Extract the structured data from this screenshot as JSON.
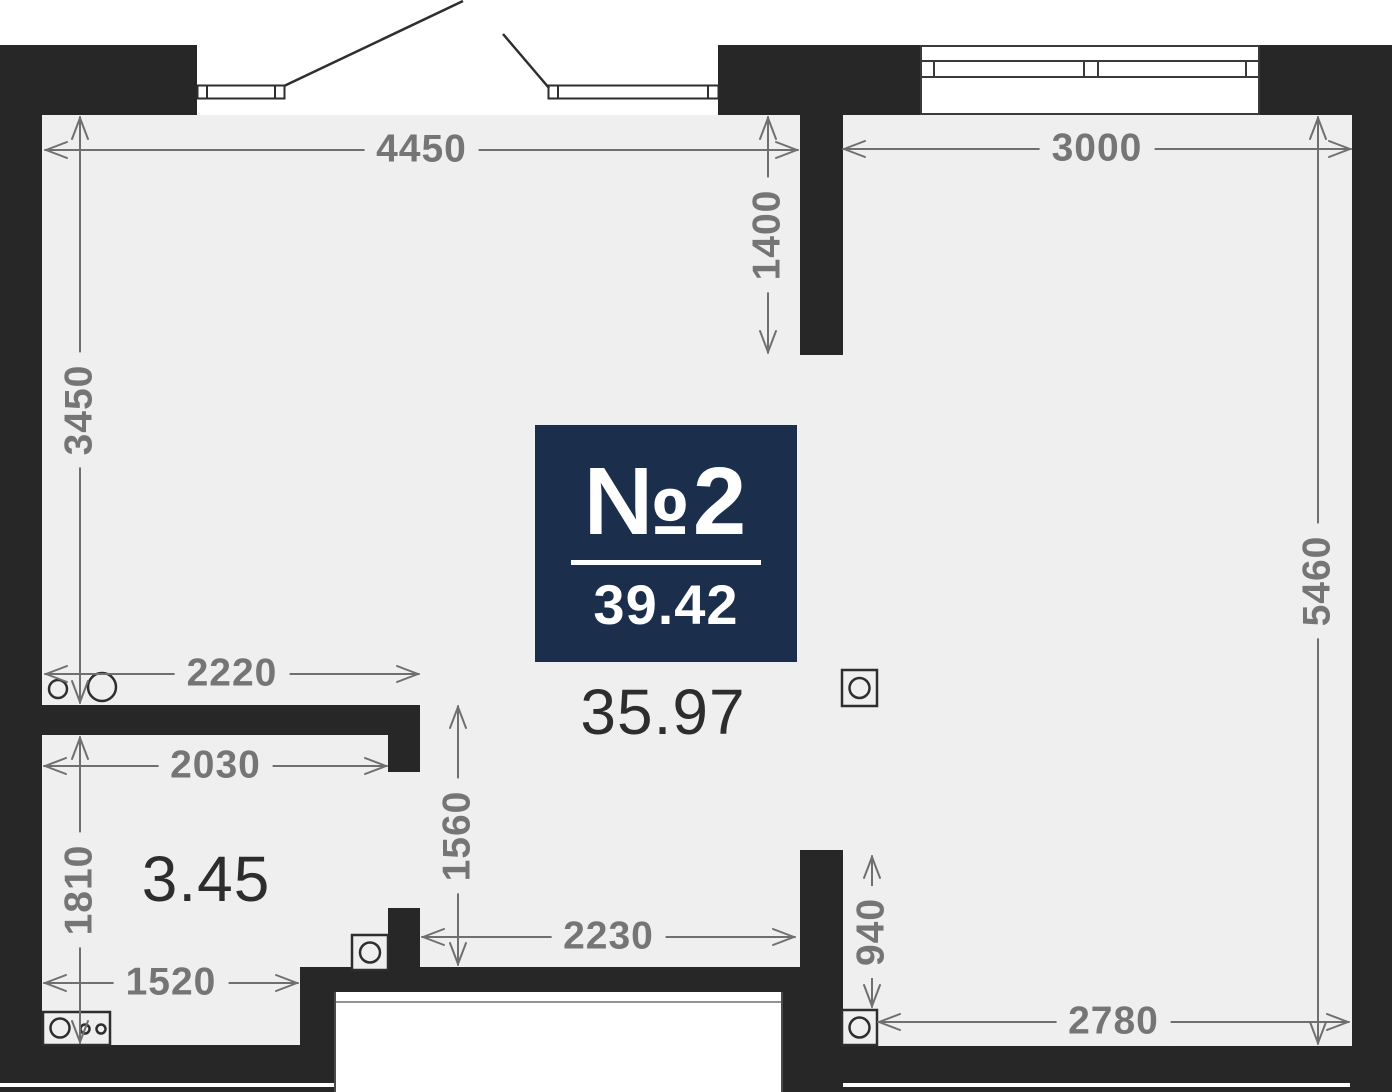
{
  "badge": {
    "number": "№2",
    "area": "39.42"
  },
  "room_areas": [
    {
      "id": "main-room",
      "label": "35.97",
      "x": 663,
      "y": 712
    },
    {
      "id": "kitchen",
      "label": "3.45",
      "x": 206,
      "y": 879
    }
  ],
  "dimensions": [
    {
      "label": "4450",
      "o": "h",
      "x1": 45,
      "x2": 798,
      "y": 150
    },
    {
      "label": "3000",
      "o": "h",
      "x1": 843,
      "x2": 1351,
      "y": 149
    },
    {
      "label": "2220",
      "o": "h",
      "x1": 45,
      "x2": 419,
      "y": 674
    },
    {
      "label": "2030",
      "o": "h",
      "x1": 44,
      "x2": 387,
      "y": 766
    },
    {
      "label": "2230",
      "o": "h",
      "x1": 422,
      "x2": 795,
      "y": 937
    },
    {
      "label": "1520",
      "o": "h",
      "x1": 44,
      "x2": 298,
      "y": 983
    },
    {
      "label": "2780",
      "o": "h",
      "x1": 878,
      "x2": 1349,
      "y": 1022
    },
    {
      "label": "3450",
      "o": "v",
      "y1": 117,
      "y2": 703,
      "x": 80
    },
    {
      "label": "1400",
      "o": "v",
      "y1": 117,
      "y2": 353,
      "x": 768
    },
    {
      "label": "5460",
      "o": "v",
      "y1": 117,
      "y2": 1044,
      "x": 1318
    },
    {
      "label": "1810",
      "o": "v",
      "y1": 737,
      "y2": 1043,
      "x": 80
    },
    {
      "label": "1560",
      "o": "v",
      "y1": 706,
      "y2": 965,
      "x": 458
    },
    {
      "label": "940",
      "o": "v",
      "y1": 856,
      "y2": 1007,
      "x": 872
    }
  ],
  "colors": {
    "wall": "#272727",
    "floor": "#efefef",
    "badge_bg": "#1b2f4d",
    "dim_line": "#6f6f6f",
    "dim_text": "#757575",
    "area_text": "#2d2d2d",
    "fixture_line": "#2e2e2e"
  },
  "geometry": {
    "floor": {
      "x": 42,
      "y": 115,
      "w": 1310,
      "h": 931
    },
    "walls": [
      {
        "x": 0,
        "y": 45,
        "w": 197,
        "h": 70
      },
      {
        "x": 0,
        "y": 45,
        "w": 42,
        "h": 1047
      },
      {
        "x": 718,
        "y": 45,
        "w": 202,
        "h": 70
      },
      {
        "x": 800,
        "y": 45,
        "w": 43,
        "h": 310
      },
      {
        "x": 1260,
        "y": 45,
        "w": 132,
        "h": 70
      },
      {
        "x": 1352,
        "y": 45,
        "w": 40,
        "h": 1047
      },
      {
        "x": 42,
        "y": 705,
        "w": 378,
        "h": 30
      },
      {
        "x": 388,
        "y": 735,
        "w": 32,
        "h": 37
      },
      {
        "x": 388,
        "y": 908,
        "w": 32,
        "h": 84
      },
      {
        "x": 300,
        "y": 967,
        "w": 500,
        "h": 25
      },
      {
        "x": 300,
        "y": 967,
        "w": 34,
        "h": 125
      },
      {
        "x": 0,
        "y": 1045,
        "w": 334,
        "h": 47
      },
      {
        "x": 800,
        "y": 850,
        "w": 43,
        "h": 242
      },
      {
        "x": 783,
        "y": 992,
        "w": 60,
        "h": 100
      },
      {
        "x": 797,
        "y": 1046,
        "w": 595,
        "h": 46
      }
    ],
    "inset_lines": [
      {
        "x": 0,
        "y": 1083,
        "w": 334,
        "h": 4
      },
      {
        "x": 843,
        "y": 1083,
        "w": 507,
        "h": 4
      }
    ],
    "niche": {
      "x": 334,
      "y": 992,
      "w": 449,
      "h": 100,
      "rail_offset": 9
    },
    "window": {
      "x": 920,
      "y": 45,
      "w": 340,
      "h": 70,
      "hline_offsets": [
        15,
        31
      ],
      "mullion_offsets": [
        13,
        163,
        177,
        325
      ]
    },
    "doors": [
      {
        "leaf": {
          "x": 197,
          "y": 85,
          "w": 87,
          "h": 13,
          "dividers": [
            207,
            275
          ]
        },
        "swing": [
          [
            284,
            86
          ],
          [
            463,
            1
          ]
        ]
      },
      {
        "leaf": {
          "x": 548,
          "y": 85,
          "w": 170,
          "h": 13,
          "dividers": [
            558,
            708
          ]
        },
        "swing": [
          [
            549,
            88
          ],
          [
            503,
            34
          ]
        ]
      }
    ],
    "fixtures": [
      {
        "name": "sink-circle-small",
        "type": "circle",
        "cx": 58,
        "cy": 689,
        "r": 9
      },
      {
        "name": "sink-circle-large",
        "type": "circle",
        "cx": 102,
        "cy": 687,
        "r": 14
      },
      {
        "name": "stove",
        "type": "box",
        "x": 43,
        "y": 1012,
        "w": 67,
        "h": 33,
        "circles": [
          [
            60,
            1028,
            9.5
          ],
          [
            85,
            1029,
            4.5
          ],
          [
            101,
            1029,
            4.5
          ]
        ]
      },
      {
        "name": "appliance-top",
        "type": "box",
        "x": 842,
        "y": 670,
        "w": 35,
        "h": 36,
        "circles": [
          [
            859.5,
            688,
            10
          ]
        ]
      },
      {
        "name": "appliance-left",
        "type": "box",
        "x": 352,
        "y": 935,
        "w": 36,
        "h": 35,
        "circles": [
          [
            370,
            952.5,
            10
          ]
        ]
      },
      {
        "name": "appliance-bottom",
        "type": "box",
        "x": 842,
        "y": 1010,
        "w": 35,
        "h": 35,
        "circles": [
          [
            859.5,
            1027.5,
            10
          ]
        ]
      }
    ]
  }
}
